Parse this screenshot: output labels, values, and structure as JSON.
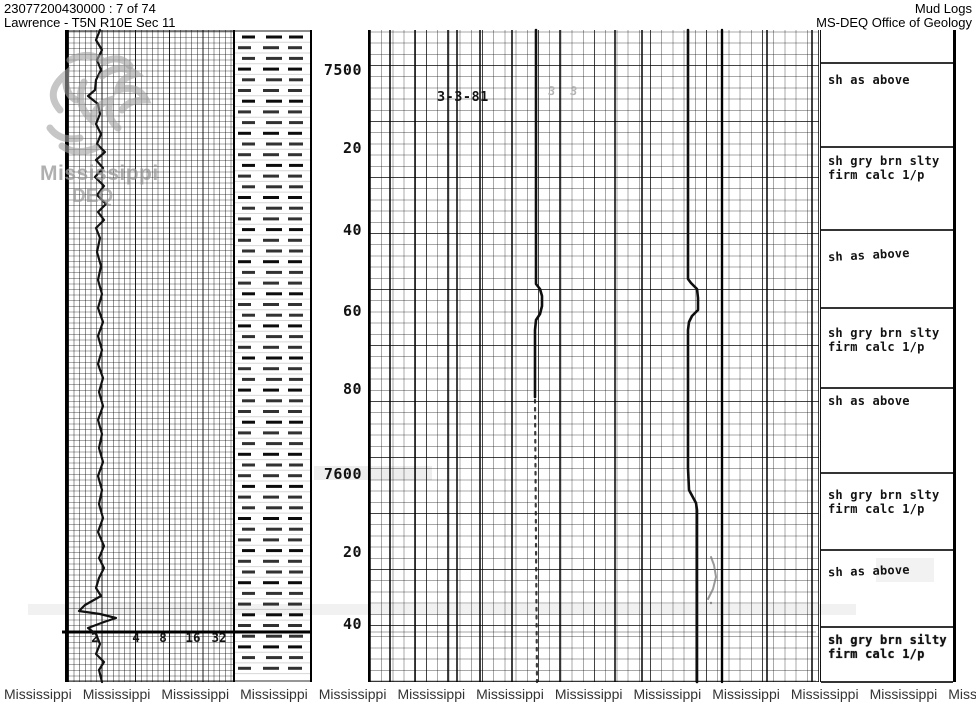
{
  "header": {
    "doc_id": "23077200430000 : 7 of 74",
    "location": "Lawrence - T5N R10E Sec 11",
    "title": "Mud Logs",
    "agency": "MS-DEQ Office of Geology"
  },
  "watermark": {
    "logo_name": "mdeq-magnolia-logo",
    "line1": "Mississippi",
    "line2": "DEQ",
    "bottom_text": "Mississippi",
    "bottom_count": 14
  },
  "log": {
    "date_annotation": "3-3-81",
    "faint_marks": [
      {
        "text": "3",
        "x": 548,
        "y": 84
      },
      {
        "text": "3",
        "x": 570,
        "y": 84
      }
    ],
    "depth_labels": [
      {
        "text": "7500",
        "y": 70
      },
      {
        "text": "20",
        "y": 148
      },
      {
        "text": "40",
        "y": 230
      },
      {
        "text": "60",
        "y": 311
      },
      {
        "text": "80",
        "y": 389
      },
      {
        "text": "7600",
        "y": 474
      },
      {
        "text": "20",
        "y": 552
      },
      {
        "text": "40",
        "y": 624
      }
    ],
    "scale_labels": [
      {
        "text": "2",
        "x": 95
      },
      {
        "text": "4",
        "x": 136
      },
      {
        "text": "8",
        "x": 163
      },
      {
        "text": "16",
        "x": 193
      },
      {
        "text": "32",
        "x": 219
      }
    ],
    "descriptions": [
      {
        "y0": 30,
        "y1": 63,
        "lines": [],
        "text_y": 0
      },
      {
        "y0": 63,
        "y1": 147,
        "lines": [
          "sh as above"
        ],
        "text_y": 73
      },
      {
        "y0": 147,
        "y1": 230,
        "lines": [
          "sh gry brn slty",
          "firm calc 1/p"
        ],
        "text_y": 154
      },
      {
        "y0": 230,
        "y1": 308,
        "lines": [
          "sh as above"
        ],
        "text_y": 248,
        "tilt": -3
      },
      {
        "y0": 308,
        "y1": 388,
        "lines": [
          "sh gry brn slty",
          "firm calc 1/p"
        ],
        "text_y": 326
      },
      {
        "y0": 388,
        "y1": 473,
        "lines": [
          "sh as above"
        ],
        "text_y": 394
      },
      {
        "y0": 473,
        "y1": 550,
        "lines": [
          "sh gry brn slty",
          "firm calc 1/p"
        ],
        "text_y": 488
      },
      {
        "y0": 550,
        "y1": 627,
        "lines": [
          "sh as above"
        ],
        "text_y": 564,
        "tilt": -2
      },
      {
        "y0": 627,
        "y1": 682,
        "lines": [
          "sh gry brn silty",
          "firm calc 1/p"
        ],
        "text_y": 633,
        "bold": true
      }
    ],
    "curves": {
      "left_curve": [
        [
          100,
          30
        ],
        [
          96,
          40
        ],
        [
          102,
          50
        ],
        [
          97,
          60
        ],
        [
          101,
          70
        ],
        [
          96,
          80
        ],
        [
          95,
          90
        ],
        [
          88,
          96
        ],
        [
          98,
          104
        ],
        [
          100,
          114
        ],
        [
          96,
          124
        ],
        [
          101,
          134
        ],
        [
          97,
          144
        ],
        [
          105,
          152
        ],
        [
          96,
          160
        ],
        [
          103,
          168
        ],
        [
          95,
          177
        ],
        [
          104,
          186
        ],
        [
          97,
          195
        ],
        [
          106,
          204
        ],
        [
          98,
          212
        ],
        [
          104,
          220
        ],
        [
          96,
          228
        ],
        [
          100,
          238
        ],
        [
          97,
          252
        ],
        [
          101,
          266
        ],
        [
          98,
          280
        ],
        [
          102,
          294
        ],
        [
          98,
          308
        ],
        [
          103,
          322
        ],
        [
          98,
          336
        ],
        [
          102,
          350
        ],
        [
          98,
          364
        ],
        [
          103,
          378
        ],
        [
          99,
          392
        ],
        [
          103,
          406
        ],
        [
          98,
          420
        ],
        [
          102,
          434
        ],
        [
          99,
          448
        ],
        [
          103,
          462
        ],
        [
          98,
          476
        ],
        [
          102,
          490
        ],
        [
          99,
          504
        ],
        [
          103,
          518
        ],
        [
          98,
          532
        ],
        [
          104,
          546
        ],
        [
          99,
          558
        ],
        [
          104,
          568
        ],
        [
          99,
          578
        ],
        [
          96,
          588
        ],
        [
          101,
          596
        ],
        [
          85,
          605
        ],
        [
          79,
          611
        ],
        [
          100,
          614
        ],
        [
          116,
          618
        ],
        [
          104,
          622
        ],
        [
          88,
          628
        ],
        [
          96,
          634
        ],
        [
          100,
          644
        ],
        [
          96,
          654
        ],
        [
          104,
          662
        ],
        [
          99,
          670
        ],
        [
          102,
          682
        ]
      ],
      "gas_curve": [
        [
          536,
          30
        ],
        [
          536,
          284
        ],
        [
          540,
          289
        ],
        [
          542,
          296
        ],
        [
          542,
          306
        ],
        [
          540,
          314
        ],
        [
          536,
          320
        ],
        [
          535,
          330
        ],
        [
          535,
          397
        ]
      ],
      "gas_curve_dotted": [
        [
          535,
          400
        ],
        [
          537,
          682
        ]
      ],
      "pressure_curve": [
        [
          688,
          30
        ],
        [
          688,
          279
        ],
        [
          691,
          283
        ],
        [
          697,
          289
        ],
        [
          698,
          298
        ],
        [
          698,
          310
        ],
        [
          692,
          316
        ],
        [
          689,
          322
        ],
        [
          688,
          330
        ],
        [
          688,
          468
        ],
        [
          689,
          490
        ],
        [
          696,
          503
        ],
        [
          697,
          510
        ],
        [
          697,
          682
        ]
      ],
      "straight_line": [
        [
          722,
          30
        ],
        [
          722,
          682
        ]
      ],
      "pencil_mark": [
        [
          711,
          557
        ],
        [
          714,
          565
        ],
        [
          716,
          577
        ],
        [
          713,
          589
        ],
        [
          708,
          599
        ]
      ]
    }
  }
}
